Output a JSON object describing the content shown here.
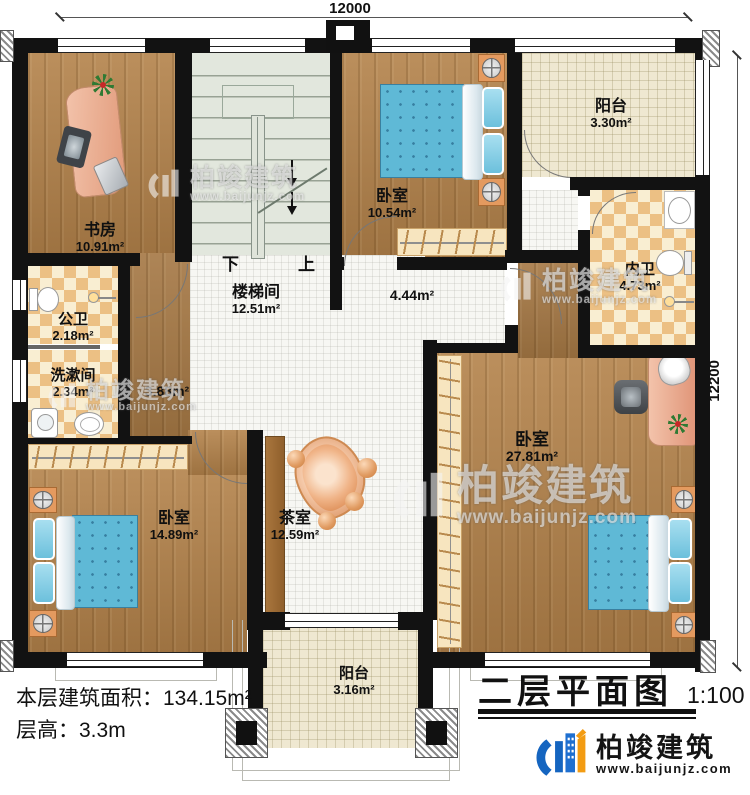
{
  "dimensions": {
    "top": "12000",
    "right": "12200"
  },
  "rooms": {
    "study": {
      "name": "书房",
      "area": "10.91m²"
    },
    "stairwell": {
      "name": "楼梯间",
      "area": "12.51m²"
    },
    "bedroom_top": {
      "name": "卧室",
      "area": "10.54m²"
    },
    "balcony_top": {
      "name": "阳台",
      "area": "3.30m²"
    },
    "inner_bath": {
      "name": "内卫",
      "area": "4.73m²"
    },
    "corridor": {
      "area": "4.44m²"
    },
    "public_bath": {
      "name": "公卫",
      "area": "2.18m²"
    },
    "washroom": {
      "name": "洗漱间",
      "area": "2.34m²"
    },
    "hall": {
      "area": "3.88m²"
    },
    "bedroom_left": {
      "name": "卧室",
      "area": "14.89m²"
    },
    "tea_room": {
      "name": "茶室",
      "area": "12.59m²"
    },
    "bedroom_master": {
      "name": "卧室",
      "area": "27.81m²"
    },
    "balcony_bottom": {
      "name": "阳台",
      "area": "3.16m²"
    }
  },
  "stairs": {
    "down_label": "下",
    "up_label": "上"
  },
  "footer": {
    "area_label": "本层建筑面积：",
    "area_value": "134.15m²",
    "floor_height_label": "层高：",
    "floor_height_value": "3.3m"
  },
  "title_block": {
    "title": "二层平面图",
    "scale": "1:100"
  },
  "brand": {
    "name": "柏竣建筑",
    "website": "www.baijunjz.com"
  }
}
